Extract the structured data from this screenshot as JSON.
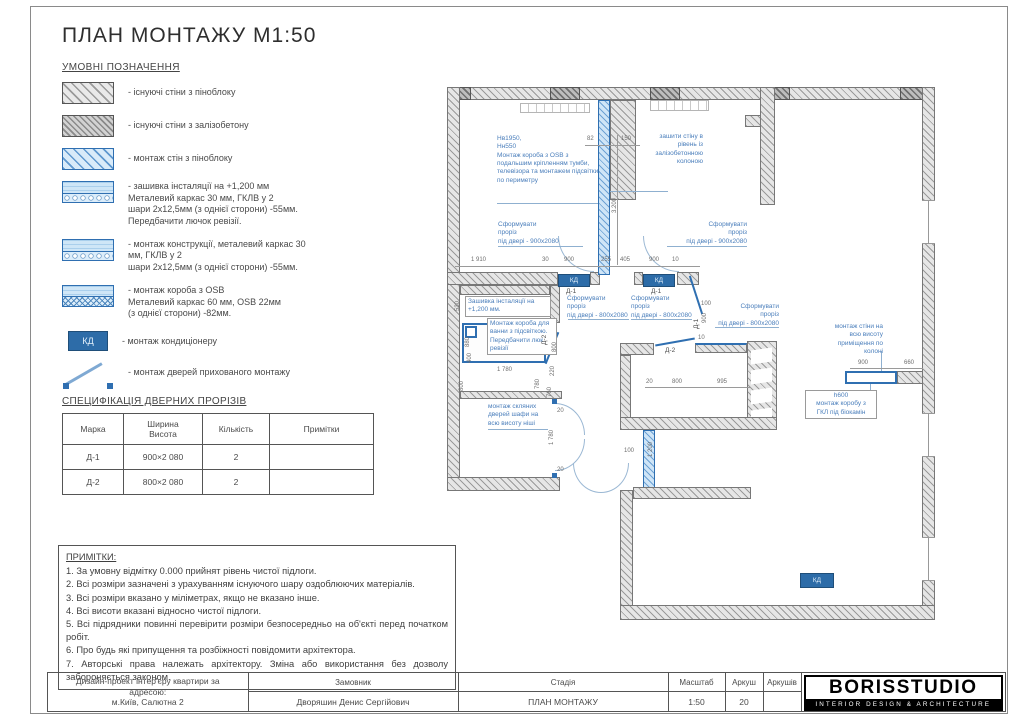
{
  "sheet": {
    "title": "ПЛАН МОНТАЖУ М1:50",
    "legend_title": "УМОВНІ ПОЗНАЧЕННЯ",
    "legend": [
      {
        "symbol": "hatch-gray",
        "label": "- існуючі стіни з піноблоку"
      },
      {
        "symbol": "hatch-gray-dense",
        "label": "- існуючі стіни з залізобетону"
      },
      {
        "symbol": "hatch-blue",
        "label": "- монтаж стін з піноблоку"
      },
      {
        "symbol": "panel dots",
        "label": "- зашивка інсталяції на +1,200 мм\nМеталевий каркас 30 мм, ГКЛВ у 2\nшари 2х12,5мм (з однієї сторони) -55мм.\nПередбачити лючок ревізії."
      },
      {
        "symbol": "panel dots",
        "label": "- монтаж конструкції, металевий каркас 30\nмм, ГКЛВ у 2\nшари 2х12,5мм (з однієї сторони) -55мм."
      },
      {
        "symbol": "panel osb",
        "label": "- монтаж короба з OSB\nМеталевий каркас 60 мм, OSB 22мм\n(з однієї сторони) -82мм."
      },
      {
        "symbol": "ac-unit",
        "label": "- монтаж кондиціонеру"
      },
      {
        "symbol": "hidden-door",
        "label": "- монтаж дверей прихованого монтажу"
      }
    ],
    "spec": {
      "title": "СПЕЦИФІКАЦІЯ  ДВЕРНИХ ПРОРІЗІВ",
      "columns": [
        "Марка",
        "Ширина\nВисота",
        "Кількість",
        "Примітки"
      ],
      "rows": [
        [
          "Д-1",
          "900×2 080",
          "2",
          ""
        ],
        [
          "Д-2",
          "800×2 080",
          "2",
          ""
        ]
      ]
    },
    "notes": {
      "title": "ПРИМІТКИ:",
      "items": [
        "1. За умовну відмітку 0.000 прийнят рівень чистої підлоги.",
        "2. Всі розміри зазначені з урахуванням існуючого шару оздоблюючих матеріалів.",
        "3. Всі розміри вказано у міліметрах, якщо не вказано інше.",
        "4. Всі висоти вказані відносно чистої підлоги.",
        "5. Всі підрядники повинні перевірити розміри безпосередньо на об'єкті перед початком робіт.",
        "6. Про будь які припущення та розбіжності повідомити архітектора.",
        "7. Авторські права належать архітектору. Зміна або використання без дозволу забороняється законом."
      ]
    },
    "titleblock": {
      "project": "Дизайн-проект інтер'єру квартири за\nадресою:\nм.Київ, Салютна 2",
      "client_label": "Замовник",
      "client": "Дворяшин Денис Сергійович",
      "stage_label": "Стадія",
      "stage": "ПЛАН МОНТАЖУ",
      "scale_label": "Масштаб",
      "scale": "1:50",
      "sheet_label": "Аркуш",
      "sheet": "20",
      "sheets_label": "Аркушів",
      "sheets": "",
      "logo": "BORISSTUDIO",
      "logo_sub": "INTERIOR DESIGN & ARCHITECTURE"
    },
    "plan": {
      "kd_label": "КД",
      "texts": [
        {
          "t": "Нв1950,\nНн550\nМонтаж короба з OSB з\nподальшим кріпленням тумби,\nтелевізора та монтажем підсвітки\nпо периметру",
          "x": 52,
          "y": 50,
          "w": 105,
          "cls": "ann"
        },
        {
          "t": "зашити стіну в\nрівень із\nзалізобетонною\nколоною",
          "x": 196,
          "y": 48,
          "w": 62,
          "al": "right",
          "cls": "ann"
        },
        {
          "t": "Сформувати\nпроріз\nпід двері - 900х2080",
          "x": 53,
          "y": 136,
          "w": 85,
          "cls": "ann"
        },
        {
          "t": "Сформувати\nпроріз\nпід двері - 900х2080",
          "x": 220,
          "y": 136,
          "w": 82,
          "al": "right",
          "cls": "ann"
        },
        {
          "t": "Зашивка інсталяції на\n+1,200 мм.",
          "x": 20,
          "y": 211,
          "w": 80,
          "cls": "ann box"
        },
        {
          "t": "Монтаж короба для\nванни з підсвіткою.\nПередбачити люк\nревізії",
          "x": 42,
          "y": 233,
          "w": 64,
          "cls": "ann box"
        },
        {
          "t": "Сформувати\nпроріз\nпід двері - 800х2080",
          "x": 122,
          "y": 210,
          "w": 62,
          "cls": "ann"
        },
        {
          "t": "Сформувати\nпроріз\nпід двері - 800х2080",
          "x": 186,
          "y": 210,
          "w": 62,
          "cls": "ann"
        },
        {
          "t": "Сформувати\nпроріз\nпід двері - 800х2080",
          "x": 270,
          "y": 218,
          "w": 64,
          "al": "right",
          "cls": "ann"
        },
        {
          "t": "монтаж стіни на\nвсю висоту\nприміщення по\nколоні",
          "x": 374,
          "y": 238,
          "w": 64,
          "al": "right",
          "cls": "ann"
        },
        {
          "t": "h600\nмонтаж коробу з\nГКЛ під біокамін",
          "x": 360,
          "y": 305,
          "w": 66,
          "al": "center",
          "cls": "ann box"
        },
        {
          "t": "монтаж скляних\nдверей шафи на\nвсю висоту ніші",
          "x": 43,
          "y": 318,
          "w": 62,
          "cls": "ann"
        },
        {
          "t": "82",
          "x": 142,
          "y": 51,
          "cls": "dim"
        },
        {
          "t": "150",
          "x": 176,
          "y": 51,
          "cls": "dim"
        },
        {
          "t": "3.200",
          "x": 167,
          "y": 128,
          "rot": 1,
          "cls": "dim"
        },
        {
          "t": "1 910",
          "x": 26,
          "y": 172,
          "cls": "dim"
        },
        {
          "t": "30",
          "x": 97,
          "y": 172,
          "cls": "dim"
        },
        {
          "t": "900",
          "x": 119,
          "y": 172,
          "cls": "dim"
        },
        {
          "t": "255",
          "x": 156,
          "y": 172,
          "cls": "dim"
        },
        {
          "t": "405",
          "x": 175,
          "y": 172,
          "cls": "dim"
        },
        {
          "t": "900",
          "x": 204,
          "y": 172,
          "cls": "dim"
        },
        {
          "t": "10",
          "x": 227,
          "y": 172,
          "cls": "dim"
        },
        {
          "t": "530",
          "x": 10,
          "y": 226,
          "rot": 1,
          "cls": "dim"
        },
        {
          "t": "880",
          "x": 20,
          "y": 262,
          "rot": 1,
          "cls": "dim"
        },
        {
          "t": "400",
          "x": 22,
          "y": 278,
          "rot": 1,
          "cls": "dim"
        },
        {
          "t": "800",
          "x": 14,
          "y": 306,
          "rot": 1,
          "cls": "dim"
        },
        {
          "t": "1 780",
          "x": 52,
          "y": 282,
          "cls": "dim"
        },
        {
          "t": "780",
          "x": 90,
          "y": 304,
          "rot": 1,
          "cls": "dim"
        },
        {
          "t": "760",
          "x": 102,
          "y": 312,
          "rot": 1,
          "cls": "dim"
        },
        {
          "t": "Д-2",
          "x": 96,
          "y": 260,
          "rot": 1,
          "cls": "lbl"
        },
        {
          "t": "800",
          "x": 107,
          "y": 267,
          "rot": 1,
          "cls": "dim"
        },
        {
          "t": "220",
          "x": 105,
          "y": 291,
          "rot": 1,
          "cls": "dim"
        },
        {
          "t": "Д-1",
          "x": 121,
          "y": 203,
          "cls": "lbl"
        },
        {
          "t": "Д-1",
          "x": 206,
          "y": 203,
          "cls": "lbl"
        },
        {
          "t": "Д-1",
          "x": 248,
          "y": 244,
          "rot": 1,
          "cls": "lbl"
        },
        {
          "t": "100",
          "x": 256,
          "y": 216,
          "cls": "dim"
        },
        {
          "t": "900",
          "x": 257,
          "y": 238,
          "rot": 1,
          "cls": "dim"
        },
        {
          "t": "10",
          "x": 253,
          "y": 250,
          "cls": "dim"
        },
        {
          "t": "Д-2",
          "x": 220,
          "y": 262,
          "cls": "lbl"
        },
        {
          "t": "20",
          "x": 201,
          "y": 294,
          "cls": "dim"
        },
        {
          "t": "800",
          "x": 227,
          "y": 294,
          "cls": "dim"
        },
        {
          "t": "995",
          "x": 272,
          "y": 294,
          "cls": "dim"
        },
        {
          "t": "100",
          "x": 179,
          "y": 363,
          "cls": "dim"
        },
        {
          "t": "1 200",
          "x": 203,
          "y": 372,
          "rot": 1,
          "cls": "dim"
        },
        {
          "t": "20",
          "x": 112,
          "y": 323,
          "cls": "dim"
        },
        {
          "t": "1 780",
          "x": 104,
          "y": 360,
          "rot": 1,
          "cls": "dim"
        },
        {
          "t": "20",
          "x": 112,
          "y": 382,
          "cls": "dim"
        },
        {
          "t": "900",
          "x": 413,
          "y": 275,
          "cls": "dim"
        },
        {
          "t": "660",
          "x": 459,
          "y": 275,
          "cls": "dim"
        }
      ]
    }
  }
}
